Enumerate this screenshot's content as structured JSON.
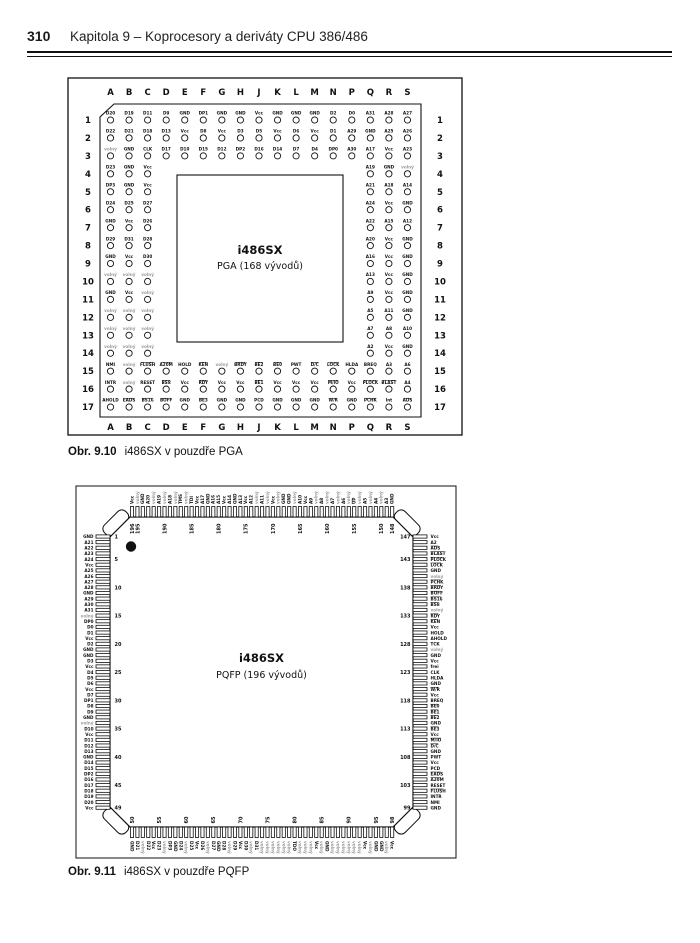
{
  "header": {
    "page_number": "310",
    "title": "Kapitola 9 – Koprocesory a deriváty CPU 386/486"
  },
  "figures": [
    {
      "name": "pga",
      "caption_label": "Obr. 9.10",
      "caption_text": "i486SX v pouzdře PGA",
      "center": {
        "chip": "i486SX",
        "package": "PGA (168 vývodů)"
      },
      "columns": [
        "A",
        "B",
        "C",
        "D",
        "E",
        "F",
        "G",
        "H",
        "J",
        "K",
        "L",
        "M",
        "N",
        "P",
        "Q",
        "R",
        "S"
      ],
      "row_count": 17,
      "nc_label": "volný",
      "grid": [
        [
          "D20",
          "D19",
          "D11",
          "D9",
          "GND",
          "DP1",
          "GND",
          "GND",
          "Vcc",
          "GND",
          "GND",
          "GND",
          "D2",
          "D0",
          "A31",
          "A28",
          "A27"
        ],
        [
          "D22",
          "D21",
          "D18",
          "D13",
          "Vcc",
          "D8",
          "Vcc",
          "D3",
          "D5",
          "Vcc",
          "D6",
          "Vcc",
          "D1",
          "A29",
          "GND",
          "A25",
          "A26"
        ],
        [
          "volný",
          "GND",
          "CLK",
          "D17",
          "D10",
          "D15",
          "D12",
          "DP2",
          "D16",
          "D14",
          "D7",
          "D4",
          "DP0",
          "A30",
          "A17",
          "Vcc",
          "A23"
        ],
        [
          "D23",
          "GND",
          "Vcc",
          null,
          null,
          null,
          null,
          null,
          null,
          null,
          null,
          null,
          null,
          null,
          "A19",
          "GND",
          "volný"
        ],
        [
          "DP3",
          "GND",
          "Vcc",
          null,
          null,
          null,
          null,
          null,
          null,
          null,
          null,
          null,
          null,
          null,
          "A21",
          "A18",
          "A14"
        ],
        [
          "D24",
          "D25",
          "D27",
          null,
          null,
          null,
          null,
          null,
          null,
          null,
          null,
          null,
          null,
          null,
          "A24",
          "Vcc",
          "GND"
        ],
        [
          "GND",
          "Vcc",
          "D26",
          null,
          null,
          null,
          null,
          null,
          null,
          null,
          null,
          null,
          null,
          null,
          "A22",
          "A15",
          "A12"
        ],
        [
          "D29",
          "D31",
          "D28",
          null,
          null,
          null,
          null,
          null,
          null,
          null,
          null,
          null,
          null,
          null,
          "A20",
          "Vcc",
          "GND"
        ],
        [
          "GND",
          "Vcc",
          "D30",
          null,
          null,
          null,
          null,
          null,
          null,
          null,
          null,
          null,
          null,
          null,
          "A16",
          "Vcc",
          "GND"
        ],
        [
          "volný",
          "volný",
          "volný",
          null,
          null,
          null,
          null,
          null,
          null,
          null,
          null,
          null,
          null,
          null,
          "A13",
          "Vcc",
          "GND"
        ],
        [
          "GND",
          "Vcc",
          "volný",
          null,
          null,
          null,
          null,
          null,
          null,
          null,
          null,
          null,
          null,
          null,
          "A9",
          "Vcc",
          "GND"
        ],
        [
          "volný",
          "volný",
          "volný",
          null,
          null,
          null,
          null,
          null,
          null,
          null,
          null,
          null,
          null,
          null,
          "A5",
          "A11",
          "GND"
        ],
        [
          "volný",
          "volný",
          "volný",
          null,
          null,
          null,
          null,
          null,
          null,
          null,
          null,
          null,
          null,
          null,
          "A7",
          "A8",
          "A10"
        ],
        [
          "volný",
          "volný",
          "volný",
          null,
          null,
          null,
          null,
          null,
          null,
          null,
          null,
          null,
          null,
          null,
          "A2",
          "Vcc",
          "GND"
        ],
        [
          "NMI",
          "volný",
          "~FLUSH",
          "~A20M",
          "HOLD",
          "~KEN",
          "volný",
          "~BRDY",
          "~BE2",
          "~BE0",
          "PWT",
          "~D/C",
          "~LOCK",
          "HLDA",
          "BREQ",
          "A3",
          "A6"
        ],
        [
          "INTR",
          "volný",
          "RESET",
          "~BS8",
          "Vcc",
          "~RDY",
          "Vcc",
          "Vcc",
          "~BE1",
          "Vcc",
          "Vcc",
          "Vcc",
          "~M/IO",
          "Vcc",
          "~PLOCK",
          "~BLAST",
          "A4"
        ],
        [
          "AHOLD",
          "~EADS",
          "~BS16",
          "~BOFF",
          "GND",
          "~BE3",
          "GND",
          "GND",
          "PCD",
          "GND",
          "GND",
          "GND",
          "~W/R",
          "GND",
          "~PCHK",
          "Int",
          "~ADS"
        ]
      ]
    },
    {
      "name": "pqfp",
      "caption_label": "Obr. 9.11",
      "caption_text": "i486SX v pouzdře PQFP",
      "center": {
        "chip": "i486SX",
        "package": "PQFP (196 vývodů)"
      },
      "nc_label": "volný",
      "sides": {
        "left": {
          "labels": [
            "GND",
            "A21",
            "A22",
            "A23",
            "A24",
            "Vcc",
            "A25",
            "A26",
            "A27",
            "A28",
            "GND",
            "A29",
            "A30",
            "A31",
            "volný",
            "DP0",
            "D0",
            "D1",
            "Vcc",
            "D2",
            "GND",
            "GND",
            "D3",
            "Vcc",
            "D4",
            "D5",
            "D6",
            "Vcc",
            "D7",
            "DP1",
            "D8",
            "D9",
            "GND",
            "volný",
            "D10",
            "Vcc",
            "D11",
            "D12",
            "D13",
            "GND",
            "D14",
            "D15",
            "DP2",
            "D16",
            "D17",
            "D18",
            "D19",
            "D20",
            "Vcc"
          ],
          "markers": [
            [
              0,
              "1"
            ],
            [
              4,
              "5"
            ],
            [
              9,
              "10"
            ],
            [
              14,
              "15"
            ],
            [
              19,
              "20"
            ],
            [
              24,
              "25"
            ],
            [
              29,
              "30"
            ],
            [
              34,
              "35"
            ],
            [
              39,
              "40"
            ],
            [
              44,
              "45"
            ],
            [
              48,
              "49"
            ]
          ]
        },
        "bottom": {
          "labels": [
            "GND",
            "D21",
            "volný",
            "D22",
            "Vcc",
            "D23",
            "volný",
            "DP3",
            "GND",
            "D24",
            "volný",
            "D25",
            "Vcc",
            "D26",
            "volný",
            "D27",
            "GND",
            "D28",
            "volný",
            "D29",
            "Vcc",
            "D30",
            "volný",
            "D31",
            "volný",
            "volný",
            "volný",
            "volný",
            "volný",
            "volný",
            "TDO",
            "volný",
            "volný",
            "volný",
            "Vcc",
            "volný",
            "GND",
            "volný",
            "volný",
            "volný",
            "volný",
            "volný",
            "volný",
            "Vcc",
            "volný",
            "GND",
            "GND",
            "volný",
            "Vcc"
          ],
          "markers": [
            [
              0,
              "50"
            ],
            [
              5,
              "55"
            ],
            [
              10,
              "60"
            ],
            [
              15,
              "65"
            ],
            [
              20,
              "70"
            ],
            [
              25,
              "75"
            ],
            [
              30,
              "80"
            ],
            [
              35,
              "85"
            ],
            [
              40,
              "90"
            ],
            [
              45,
              "95"
            ],
            [
              48,
              "98"
            ]
          ]
        },
        "right": {
          "labels": [
            "Vcc",
            "A2",
            "~ADS",
            "~BLAST",
            "~PLOCK",
            "~LOCK",
            "GND",
            "volný",
            "~PCHK",
            "~BRDY",
            "~BOFF",
            "~BS16",
            "~BS8",
            "volný",
            "~RDY",
            "~KEN",
            "Vcc",
            "HOLD",
            "AHOLD",
            "TCK",
            "volný",
            "GND",
            "Vcc",
            "frei",
            "CLK",
            "HLDA",
            "GND",
            "~W/R",
            "Vcc",
            "BREQ",
            "~BE0",
            "~BE1",
            "~BE2",
            "GND",
            "~BE3",
            "Vcc",
            "~M/IO",
            "~D/C",
            "GND",
            "PWT",
            "Vcc",
            "PCD",
            "~EADS",
            "~A20M",
            "RESET",
            "~FLUSH",
            "INTR",
            "NMI",
            "GND"
          ],
          "markers": [
            [
              0,
              "147"
            ],
            [
              4,
              "143"
            ],
            [
              9,
              "138"
            ],
            [
              14,
              "133"
            ],
            [
              19,
              "128"
            ],
            [
              24,
              "123"
            ],
            [
              29,
              "118"
            ],
            [
              34,
              "113"
            ],
            [
              39,
              "108"
            ],
            [
              44,
              "103"
            ],
            [
              48,
              "99"
            ]
          ]
        },
        "top": {
          "labels": [
            "Vcc",
            "volný",
            "GND",
            "A20",
            "volný",
            "A19",
            "volný",
            "A18",
            "volný",
            "TMS",
            "volný",
            "TDI",
            "Vcc",
            "A17",
            "GND",
            "A16",
            "A15",
            "Vcc",
            "A14",
            "GND",
            "A13",
            "Vcc",
            "A12",
            "volný",
            "A11",
            "volný",
            "Vcc",
            "volný",
            "GND",
            "GND",
            "volný",
            "A10",
            "Vcc",
            "A9",
            "volný",
            "A8",
            "volný",
            "A7",
            "volný",
            "A6",
            "volný",
            "~UP",
            "volný",
            "A5",
            "volný",
            "A4",
            "volný",
            "A3",
            "GND"
          ],
          "markers": [
            [
              0,
              "196"
            ],
            [
              1,
              "195"
            ],
            [
              6,
              "190"
            ],
            [
              11,
              "185"
            ],
            [
              16,
              "180"
            ],
            [
              21,
              "175"
            ],
            [
              26,
              "170"
            ],
            [
              31,
              "165"
            ],
            [
              36,
              "160"
            ],
            [
              41,
              "155"
            ],
            [
              46,
              "150"
            ],
            [
              48,
              "148"
            ]
          ]
        }
      }
    }
  ]
}
